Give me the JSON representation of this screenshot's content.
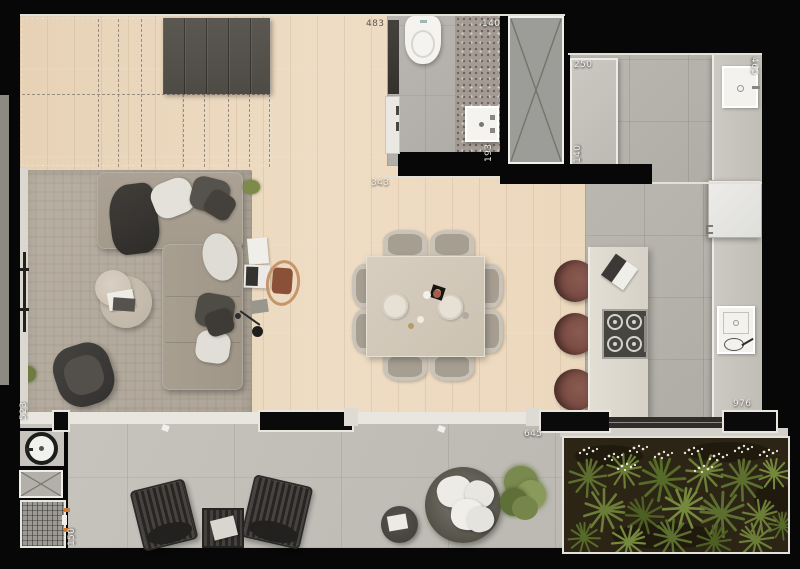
{
  "dimensions": {
    "living_top": "483",
    "bath_niche": "140",
    "bath_depth": "193",
    "hall": "343",
    "kitchen_run_top": "250",
    "kitchen_run_side": "140",
    "kitchen_right": "465",
    "kitchen_length": "976",
    "terrace_opening": "645",
    "terrace_side": "523",
    "service_strip": "150"
  },
  "colors": {
    "wall": "#070707",
    "wood_floor": "#ecd9c0",
    "kitchen_tile": "#b4b1aa",
    "terrace_tile": "#c3c0b9",
    "garden_soil": "#2c2415",
    "fern_green": "#6b7d36",
    "stool_leather": "#7d5048",
    "sofa_fabric": "#a79e90",
    "grill_handle_orange": "#c87f3a"
  }
}
